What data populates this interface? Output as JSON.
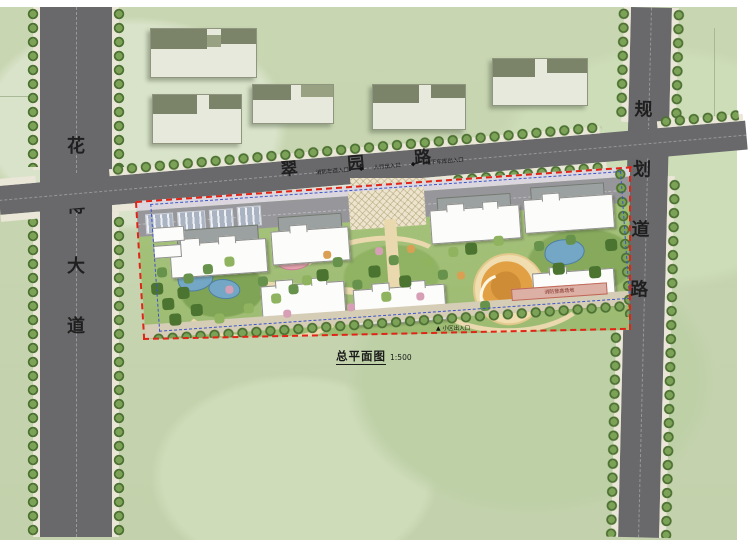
{
  "drawing": {
    "title": "总平面图",
    "scale": "1:500"
  },
  "roads": {
    "north": {
      "name": "翠园路",
      "chars": [
        "翠",
        "园",
        "路"
      ]
    },
    "west": {
      "name": "花博大道",
      "chars": [
        "花",
        "博",
        "大",
        "道"
      ]
    },
    "east": {
      "name": "规划道路",
      "chars": [
        "规",
        "划",
        "道",
        "路"
      ]
    }
  },
  "annotations": {
    "entrances_north": [
      "消防车道入口",
      "人行出入口",
      "地下车库出入口"
    ],
    "entrance_south": "小区出入口",
    "fire_lane_label": "消防登高场地",
    "marker_glyph": "◆",
    "entrance_south_glyph": "▲"
  },
  "colors": {
    "field_green": "#c8d6b2",
    "road_gray": "#69696c",
    "sidewalk": "#eae6d8",
    "tree_green": "#4d7133",
    "site_boundary_red": "#e02518",
    "setback_blue": "#3c55c8",
    "path_tan": "#ead9ae",
    "water_blue": "#74a7c6",
    "playground_orange": "#e2a045",
    "pool_pink": "#e8a2b0",
    "building_white": "#fcfcfb"
  }
}
